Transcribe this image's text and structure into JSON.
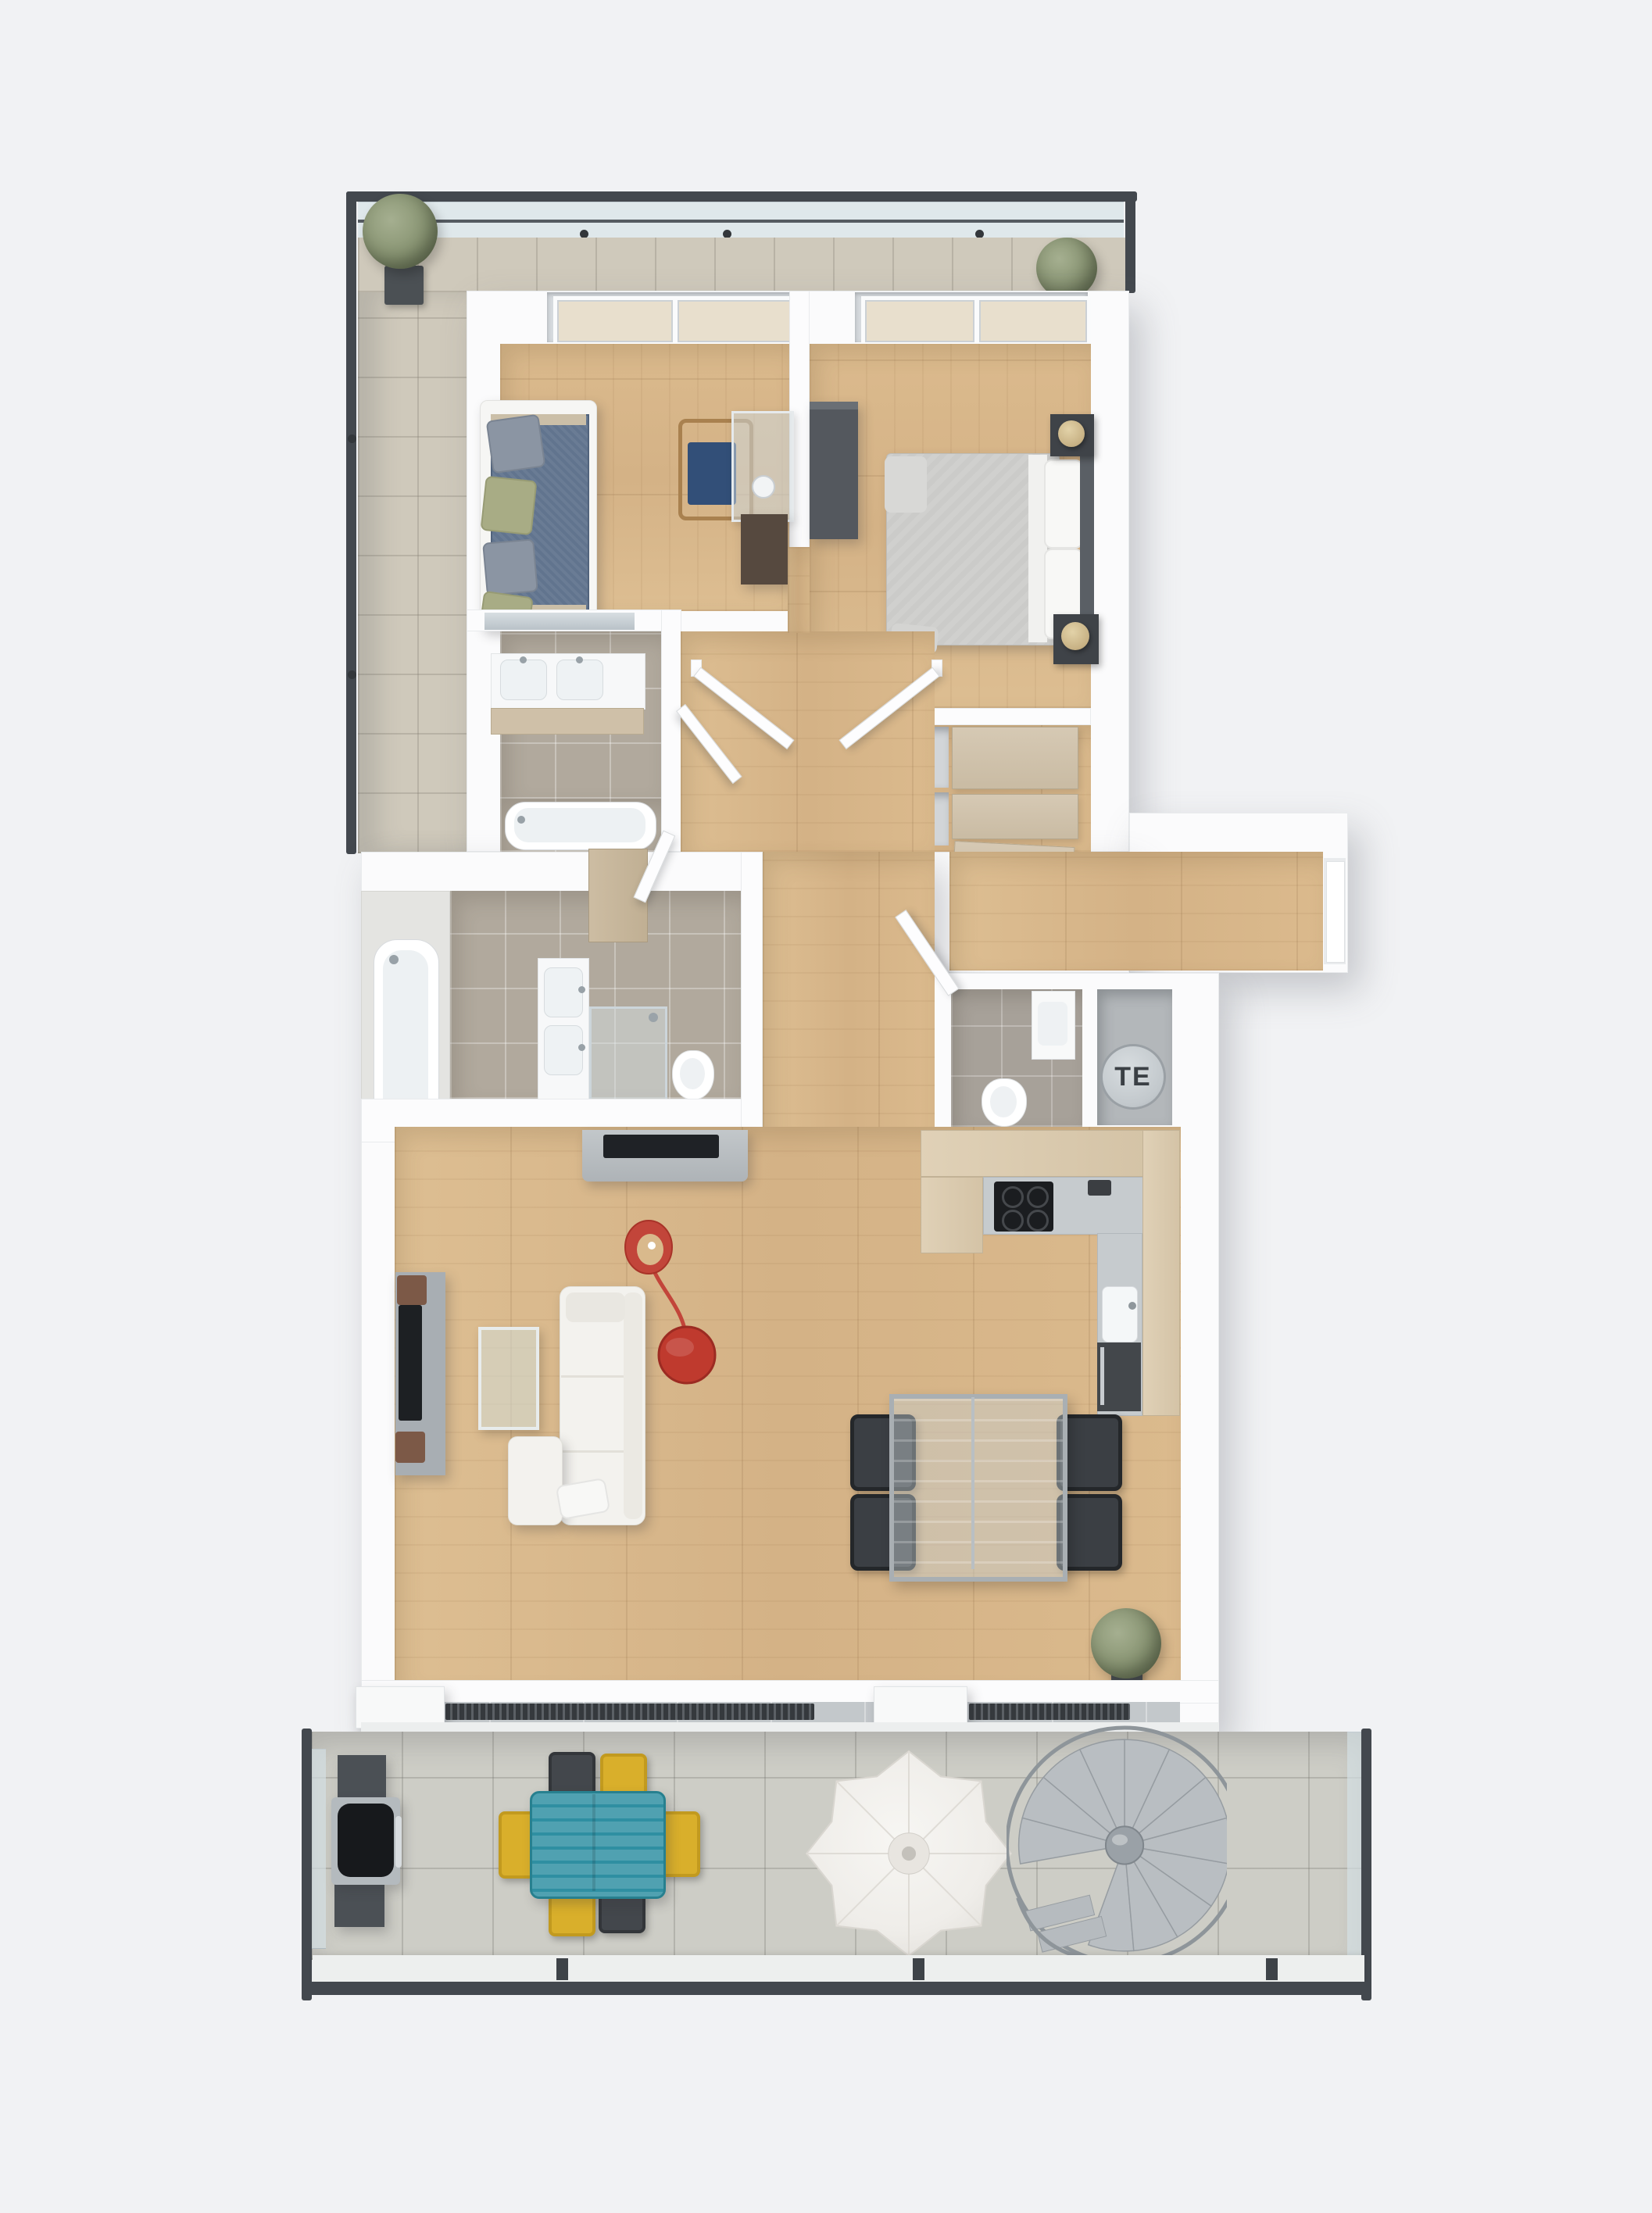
{
  "scene": {
    "type": "3d-floor-plan",
    "view": "top-down-axonometric-render",
    "labels": {
      "technical_shaft": "TE"
    }
  },
  "palette": {
    "background": "#f1f2f4",
    "wall_white": "#fcfcfd",
    "wood_floor": "#d8b88c",
    "bath_tile_taupe": "#b1a99d",
    "wc_tile_gray": "#a7a199",
    "terrace_tile_top": "#cfc9bb",
    "terrace_tile_bottom": "#cdcdc6",
    "railing_dark": "#43484e",
    "glass_balustrade": "#d6e2e7",
    "accent_lamp_red": "#c0392e",
    "outdoor_table_teal": "#2f8fa2",
    "outdoor_chair_yellow": "#d9af2b",
    "outdoor_chair_dark": "#43474c",
    "sofa_white": "#f3f2ee",
    "bed_blanket_gray": "#cbcbc9",
    "daybed_blue": "#61748e",
    "kitchen_wood": "#dccdb2",
    "counter_gray": "#c6cbce",
    "wardrobe_beige": "#d0c3ad",
    "plant_green": "#879371",
    "te_circle_gray": "#ccd1d5"
  },
  "rooms": [
    "top-terrace",
    "side-balcony",
    "office-room",
    "bedroom",
    "ensuite-bathroom",
    "inner-hallway",
    "wardrobe-dressing",
    "entry-corridor",
    "main-bathroom",
    "guest-wc",
    "technical-shaft",
    "kitchen",
    "living-dining-room",
    "lower-terrace"
  ],
  "furniture": {
    "office_room": [
      "daybed-sofa",
      "pillows",
      "glass-desk",
      "desk-lamp",
      "wooden-chair"
    ],
    "bedroom": [
      "double-bed",
      "pillows",
      "headboard",
      "nightstands",
      "table-lamps",
      "dresser"
    ],
    "ensuite_bathroom": [
      "mirror",
      "double-sink-vanity",
      "bathtub"
    ],
    "main_bathroom": [
      "bathtub",
      "double-sink-vanity",
      "shower",
      "toilet",
      "storage-cabinet"
    ],
    "guest_wc": [
      "toilet",
      "washbasin",
      "door"
    ],
    "kitchen": [
      "l-shaped-counter",
      "cooktop",
      "sink",
      "oven",
      "wall-cabinets"
    ],
    "living_room": [
      "tv-lowboard",
      "sideboard",
      "speakers",
      "tv",
      "coffee-table",
      "corner-sofa",
      "red-arc-floor-lamp",
      "glass-dining-table",
      "dining-chairs",
      "plant"
    ],
    "top_terrace": [
      "potted-plants",
      "glass-railing"
    ],
    "lower_terrace": [
      "bbq-grill",
      "teal-outdoor-table",
      "outdoor-chairs",
      "parasol",
      "spiral-staircase",
      "planter-boxes",
      "vent-grilles"
    ]
  }
}
